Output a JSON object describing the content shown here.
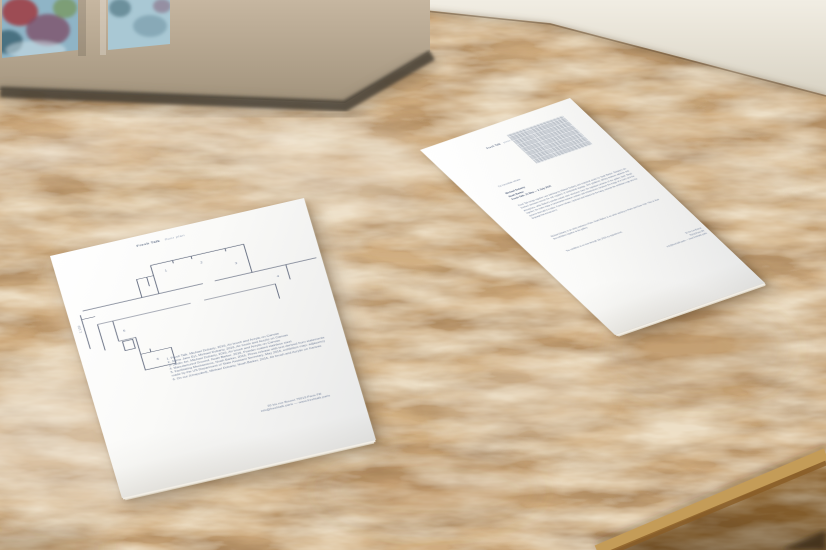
{
  "scene": {
    "description": "Two white exhibition handouts lying on an OSB chipboard tabletop in front of a stained-glass window and a white wall"
  },
  "palette": {
    "osb_base": "#d2b084",
    "osb_light_wash": "#ecdfc9",
    "osb_dark_fleck": "#8a6640",
    "wall": "#ece7dc",
    "window_frame": "#b7a791",
    "frame_shadow": "#473f34",
    "glass_blue": "#8fb4c6",
    "glass_teal": "#39606f",
    "glass_plum": "#7c4a63",
    "glass_red": "#a03a3e",
    "glass_green": "#6f8f3f",
    "paper": "#fafaf8",
    "ink": "#6b7a94",
    "plan_line": "#5a6378",
    "table_edge": "#c49c58",
    "table_side": "#a4763a",
    "corner_shadow": "#3a2a12"
  },
  "documents": {
    "left": {
      "header": {
        "title": "Fresh Talk",
        "subtitle": "floor plan"
      },
      "scale_label": "1:100",
      "plan_room_numbers": [
        "1",
        "2",
        "3",
        "4",
        "5",
        "6"
      ],
      "works": [
        "1. Fresh Talk, Michael Dobarty, 2016, Air brush and Acrylic on Canvas",
        "2. Jaime Jane Eyl, Michael Dobarty, 2016, Air brush and Acrylic on Canvas",
        "3. Jardin Jet, Michael Dobarty, 2016, Air brush and Acrylic on Canvas",
        "4. Manufactured Ground, Noah Barker, 2016, Powder coated stainless steel",
        "5. Facilitating Mechanisms, Noah Barker, 2016, Press release with text derived from statements",
        "    made by the US Department of State Assistant Secretary, May 2016, exhibition map: adjacency",
        "6. On our (Unspoiled), Michael Dobarty, Noah Barker, 2016, Air brush and Acrylic on Canvas"
      ],
      "address_line1": "30 bis rue Bouret 75019 Paris FR",
      "address_line2": "info@freshtalk.paris — www.freshtalk.paris"
    },
    "right": {
      "header": {
        "title": "Fresh Talk",
        "subtitle": "press release"
      },
      "release_line": "For immediate release",
      "title_lines": [
        "Michael Dobarty",
        "Noah Barker",
        "Fresh Talk, 21 May — 2 July 2016"
      ],
      "paragraphs": [
        "Fresh Talk brings together new paintings by Michael Dobarty and sculptural works by Noah Barker. Dobarty's air-brushed canvases borrow the soft registers of institutional signage, their gradients drifting between address and atmosphere, while Barker's powder-coated steel structures trace the logistical contours of the gallery itself. Read together, the works stage a conversation between surface and infrastructure, between the image of a room and the systems that hold it in place. A press release, reprinted and folded into the hang, extends the exhibition map into the language that announces it.",
        "Michael Dobarty is an artist working in Paris. Noah Barker is an artist working in Paris and New York. This is their first exhibition together at the gallery.",
        "The exhibition is on view through July 2016, by appointment."
      ],
      "address_lines": [
        "30 bis rue Bouret",
        "75019 Paris FR",
        "info@freshtalk.paris — www.freshtalk.paris"
      ]
    }
  }
}
